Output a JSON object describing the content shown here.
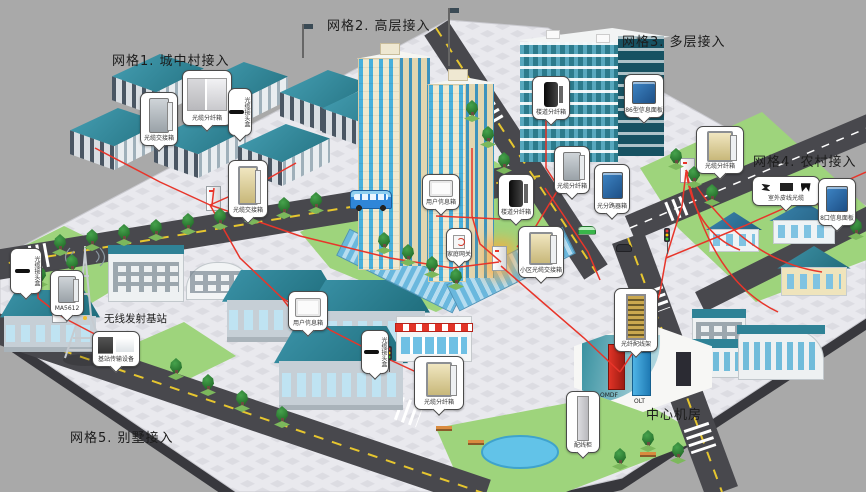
{
  "labels": {
    "grid1": "网格1. 城中村接入",
    "grid2": "网格2. 高层接入",
    "grid3": "网格3. 多层接入",
    "grid4": "网格4. 农村接入",
    "grid5": "网格5. 别墅接入",
    "central_room": "中心机房",
    "base_station": "无线发射基站",
    "omdf": "OMDF",
    "olt": "OLT"
  },
  "callouts": [
    {
      "id": "g1-jiaojiexiang-1",
      "label": "光缆交接箱",
      "device": "cabinet",
      "x": 140,
      "y": 92,
      "w": 38,
      "h": 54
    },
    {
      "id": "g1-fenxianxiang",
      "label": "光缆分纤箱",
      "device": "twobox",
      "x": 182,
      "y": 70,
      "w": 50,
      "h": 56
    },
    {
      "id": "g1-jietouhe",
      "label": "光缆接头盒",
      "device": "closure",
      "x": 228,
      "y": 88,
      "w": 24,
      "h": 48,
      "vertical": true
    },
    {
      "id": "g1-jiaojiexiang-2",
      "label": "光缆交接箱",
      "device": "cab2",
      "x": 228,
      "y": 160,
      "w": 40,
      "h": 58
    },
    {
      "id": "g2-xinxixiang",
      "label": "用户信息箱",
      "device": "wallbox",
      "x": 422,
      "y": 174,
      "w": 38,
      "h": 36
    },
    {
      "id": "g2-wangguan",
      "label": "家庭网关",
      "device": "gateway",
      "x": 446,
      "y": 228,
      "w": 26,
      "h": 34
    },
    {
      "id": "g2-fenxianxiang",
      "label": "楼道分纤箱",
      "device": "pole",
      "x": 498,
      "y": 174,
      "w": 36,
      "h": 46
    },
    {
      "id": "g2-jiaojiexiang",
      "label": "小区光缆交接箱",
      "device": "cab2",
      "x": 518,
      "y": 226,
      "w": 46,
      "h": 52
    },
    {
      "id": "g3-fenxianxiang",
      "label": "楼道分纤箱",
      "device": "pole",
      "x": 532,
      "y": 76,
      "w": 38,
      "h": 44
    },
    {
      "id": "g3-mianban",
      "label": "86型信息面板",
      "device": "panel",
      "x": 624,
      "y": 74,
      "w": 40,
      "h": 44
    },
    {
      "id": "g3-fenxianxiang2",
      "label": "光缆分纤箱",
      "device": "cabinet",
      "x": 554,
      "y": 146,
      "w": 36,
      "h": 48
    },
    {
      "id": "g3-fenluqixiang",
      "label": "光分路器箱",
      "device": "panel",
      "x": 594,
      "y": 164,
      "w": 36,
      "h": 50
    },
    {
      "id": "g4-fenxianxiang",
      "label": "光缆分纤箱",
      "device": "cab2",
      "x": 696,
      "y": 126,
      "w": 48,
      "h": 48
    },
    {
      "id": "g4-pixian",
      "label": "室外皮线光缆",
      "device": "tools",
      "x": 752,
      "y": 176,
      "w": 68,
      "h": 30
    },
    {
      "id": "g4-mianban",
      "label": "8口信息面板",
      "device": "panel",
      "x": 818,
      "y": 178,
      "w": 38,
      "h": 48
    },
    {
      "id": "left-jietouhe",
      "label": "光缆接头盒",
      "device": "closure",
      "x": 10,
      "y": 248,
      "w": 32,
      "h": 46,
      "vertical": true
    },
    {
      "id": "left-ma5612",
      "label": "MA5612",
      "device": "cabinet",
      "x": 50,
      "y": 270,
      "w": 34,
      "h": 46
    },
    {
      "id": "tower-chuanshu",
      "label": "基站传输设备",
      "device": "screens",
      "x": 92,
      "y": 331,
      "w": 48,
      "h": 36
    },
    {
      "id": "g5-xinxixiang",
      "label": "用户信息箱",
      "device": "wallbox",
      "x": 288,
      "y": 291,
      "w": 40,
      "h": 40
    },
    {
      "id": "g5-jietouhe",
      "label": "光缆接头盒",
      "device": "closure",
      "x": 361,
      "y": 330,
      "w": 28,
      "h": 44,
      "vertical": true
    },
    {
      "id": "g5-fenxianxiang",
      "label": "光缆分纤箱",
      "device": "cab2",
      "x": 414,
      "y": 356,
      "w": 50,
      "h": 54
    },
    {
      "id": "room-peixiangui",
      "label": "配线柜",
      "device": "tallcab",
      "x": 566,
      "y": 391,
      "w": 34,
      "h": 62
    },
    {
      "id": "room-odf",
      "label": "光纤配线架",
      "device": "rack",
      "x": 614,
      "y": 288,
      "w": 44,
      "h": 64
    }
  ],
  "scene": {
    "colors": {
      "bg": "#a9a9a9",
      "pave": "#e9e9ee",
      "pave2": "#dcdce2",
      "road": "#48484d",
      "lawn": "#9ed47c",
      "red": "#e8352a",
      "winBlue": "#49b0dc"
    },
    "trees": [
      [
        60,
        252
      ],
      [
        92,
        247
      ],
      [
        124,
        242
      ],
      [
        156,
        237
      ],
      [
        188,
        231
      ],
      [
        220,
        226
      ],
      [
        252,
        221
      ],
      [
        284,
        215
      ],
      [
        316,
        210
      ],
      [
        472,
        118
      ],
      [
        488,
        144
      ],
      [
        504,
        170
      ],
      [
        520,
        196
      ],
      [
        384,
        250
      ],
      [
        408,
        262
      ],
      [
        432,
        274
      ],
      [
        456,
        286
      ],
      [
        176,
        376
      ],
      [
        208,
        392
      ],
      [
        242,
        408
      ],
      [
        282,
        424
      ],
      [
        676,
        166
      ],
      [
        694,
        184
      ],
      [
        712,
        202
      ],
      [
        840,
        212
      ],
      [
        856,
        236
      ],
      [
        648,
        448
      ],
      [
        678,
        460
      ],
      [
        620,
        466
      ],
      [
        40,
        284
      ],
      [
        72,
        272
      ]
    ],
    "pedestals": [
      {
        "x": 206,
        "y": 186
      },
      {
        "x": 52,
        "y": 298
      },
      {
        "x": 492,
        "y": 246,
        "glow": true
      },
      {
        "x": 680,
        "y": 158
      }
    ]
  }
}
